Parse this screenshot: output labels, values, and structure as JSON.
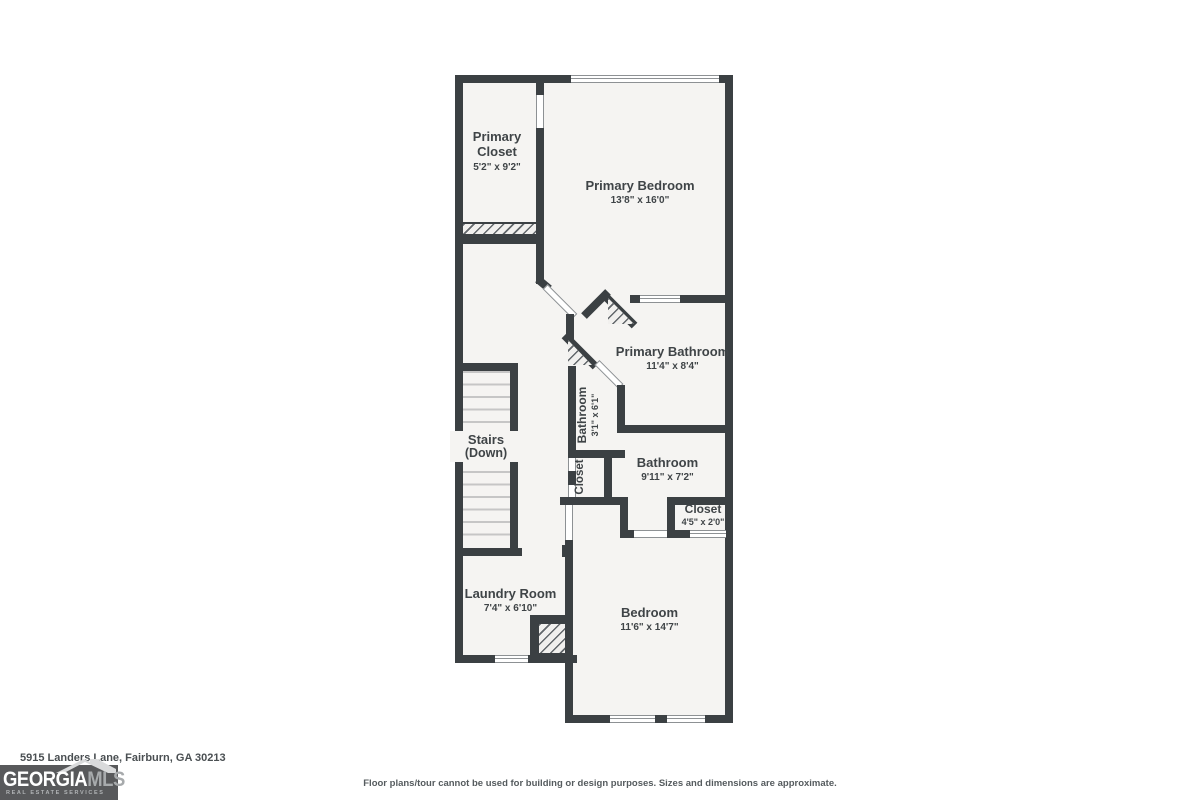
{
  "plan": {
    "rooms": {
      "primary_closet": {
        "name": "Primary Closet",
        "dims": "5'2\" x 9'2\""
      },
      "primary_bedroom": {
        "name": "Primary Bedroom",
        "dims": "13'8\" x 16'0\""
      },
      "primary_bathroom": {
        "name": "Primary Bathroom",
        "dims": "11'4\" x 8'4\""
      },
      "bathroom_small": {
        "name": "Bathroom",
        "dims": "3'1\" x 6'1\""
      },
      "hall_closet": {
        "name": "Closet"
      },
      "bathroom": {
        "name": "Bathroom",
        "dims": "9'11\" x 7'2\""
      },
      "bedroom_closet": {
        "name": "Closet",
        "dims": "4'5\" x 2'0\""
      },
      "stairs": {
        "name": "Stairs",
        "dims": "(Down)"
      },
      "laundry": {
        "name": "Laundry Room",
        "dims": "7'4\" x 6'10\""
      },
      "bedroom": {
        "name": "Bedroom",
        "dims": "11'6\" x 14'7\""
      }
    }
  },
  "footer": {
    "address": "5915 Landers Lane, Fairburn, GA 30213",
    "disclaimer": "Floor plans/tour cannot be used for building or design purposes. Sizes and dimensions are approximate."
  },
  "logo": {
    "brand_primary": "GEORGIA",
    "brand_secondary": "MLS",
    "tagline": "REAL ESTATE SERVICES"
  },
  "colors": {
    "wall": "#3b4043",
    "floor": "#f5f4f2",
    "label_text": "#3f4447",
    "logo_background": "#58595b"
  }
}
